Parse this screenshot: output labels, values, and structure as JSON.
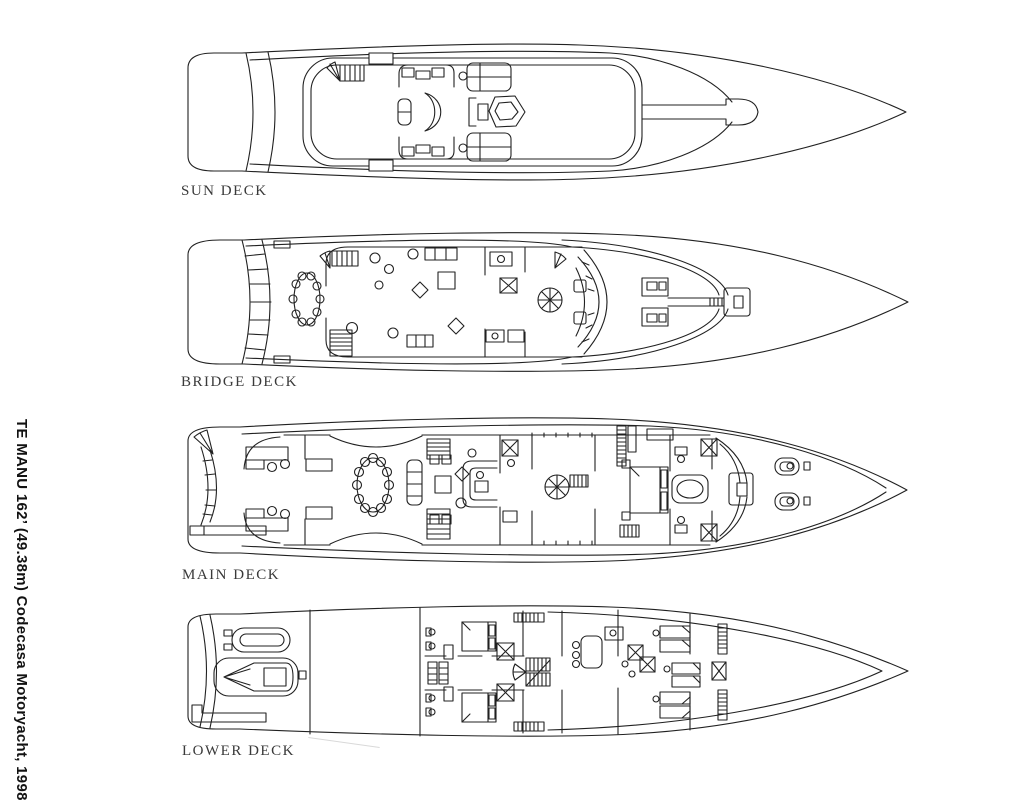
{
  "page": {
    "background_color": "#ffffff",
    "ink_color": "#212121"
  },
  "side_caption": {
    "text": "TE MANU 162’ (49.38m) Codecasa Motoryacht, 1998"
  },
  "decks": [
    {
      "label": "SUN DECK"
    },
    {
      "label": "BRIDGE DECK"
    },
    {
      "label": "MAIN DECK"
    },
    {
      "label": "LOWER DECK"
    }
  ]
}
